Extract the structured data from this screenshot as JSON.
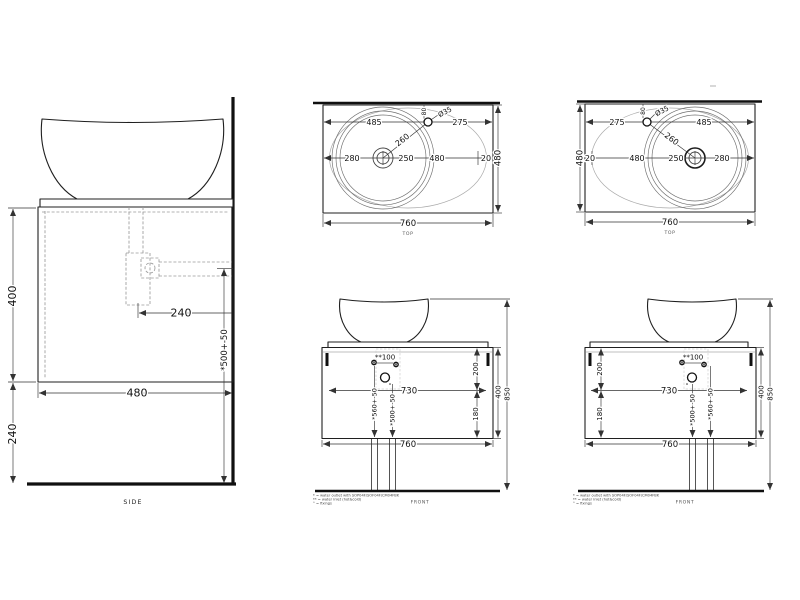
{
  "drawing_title": "countertop basin with cabinet - technical drawing",
  "colors": {
    "background": "#ffffff",
    "line": "#1f1f1f",
    "dim": "#333333",
    "hidden": "#9a9a9a"
  },
  "views": {
    "side": {
      "label": "SIDE",
      "d_cabinet_height": "400",
      "d_floor_gap": "240",
      "d_depth": "480",
      "d_trap_offset": "240",
      "d_outlet_height": "*500+-50"
    },
    "top_a": {
      "label": "TOP",
      "d_left": "485",
      "d_right": "275",
      "d_hole_setback": "80",
      "d_hole_dia": "Ø35",
      "d_diag": "260",
      "d_center_a": "280",
      "d_center_b": "250",
      "d_center_c": "480",
      "d_edge_gap": "20",
      "d_depth": "480",
      "d_width": "760"
    },
    "top_b": {
      "label": "TOP",
      "d_left": "275",
      "d_right": "485",
      "d_hole_setback": "80",
      "d_hole_dia": "Ø35",
      "d_diag": "260",
      "d_edge_gap": "20",
      "d_center_a": "480",
      "d_center_b": "250",
      "d_center_c": "280",
      "d_depth": "480",
      "d_width": "760"
    },
    "front_a": {
      "label": "FRONT",
      "d_inlet_gap": "**100",
      "d_inner_width": "730",
      "d_top_offset": "200",
      "d_bottom_offset": "180",
      "d_inlet_height": "*560+-50",
      "d_outlet_height": "*500+-50",
      "d_width": "760",
      "d_cabinet_height": "400",
      "d_total_height": "850"
    },
    "front_b": {
      "label": "FRONT",
      "d_inlet_gap": "**100",
      "d_inner_width": "730",
      "d_top_offset": "200",
      "d_bottom_offset": "180",
      "d_outlet_height": "*500+-50",
      "d_inlet_height": "*560+-50",
      "d_width": "760",
      "d_cabinet_height": "400",
      "d_total_height": "850"
    }
  },
  "notes": {
    "line1": "* = water outlet with SOP04F/SOF04F/CM04FBK",
    "line2": "** = water inlet (hot&cold)",
    "line3": "° = fixings"
  }
}
